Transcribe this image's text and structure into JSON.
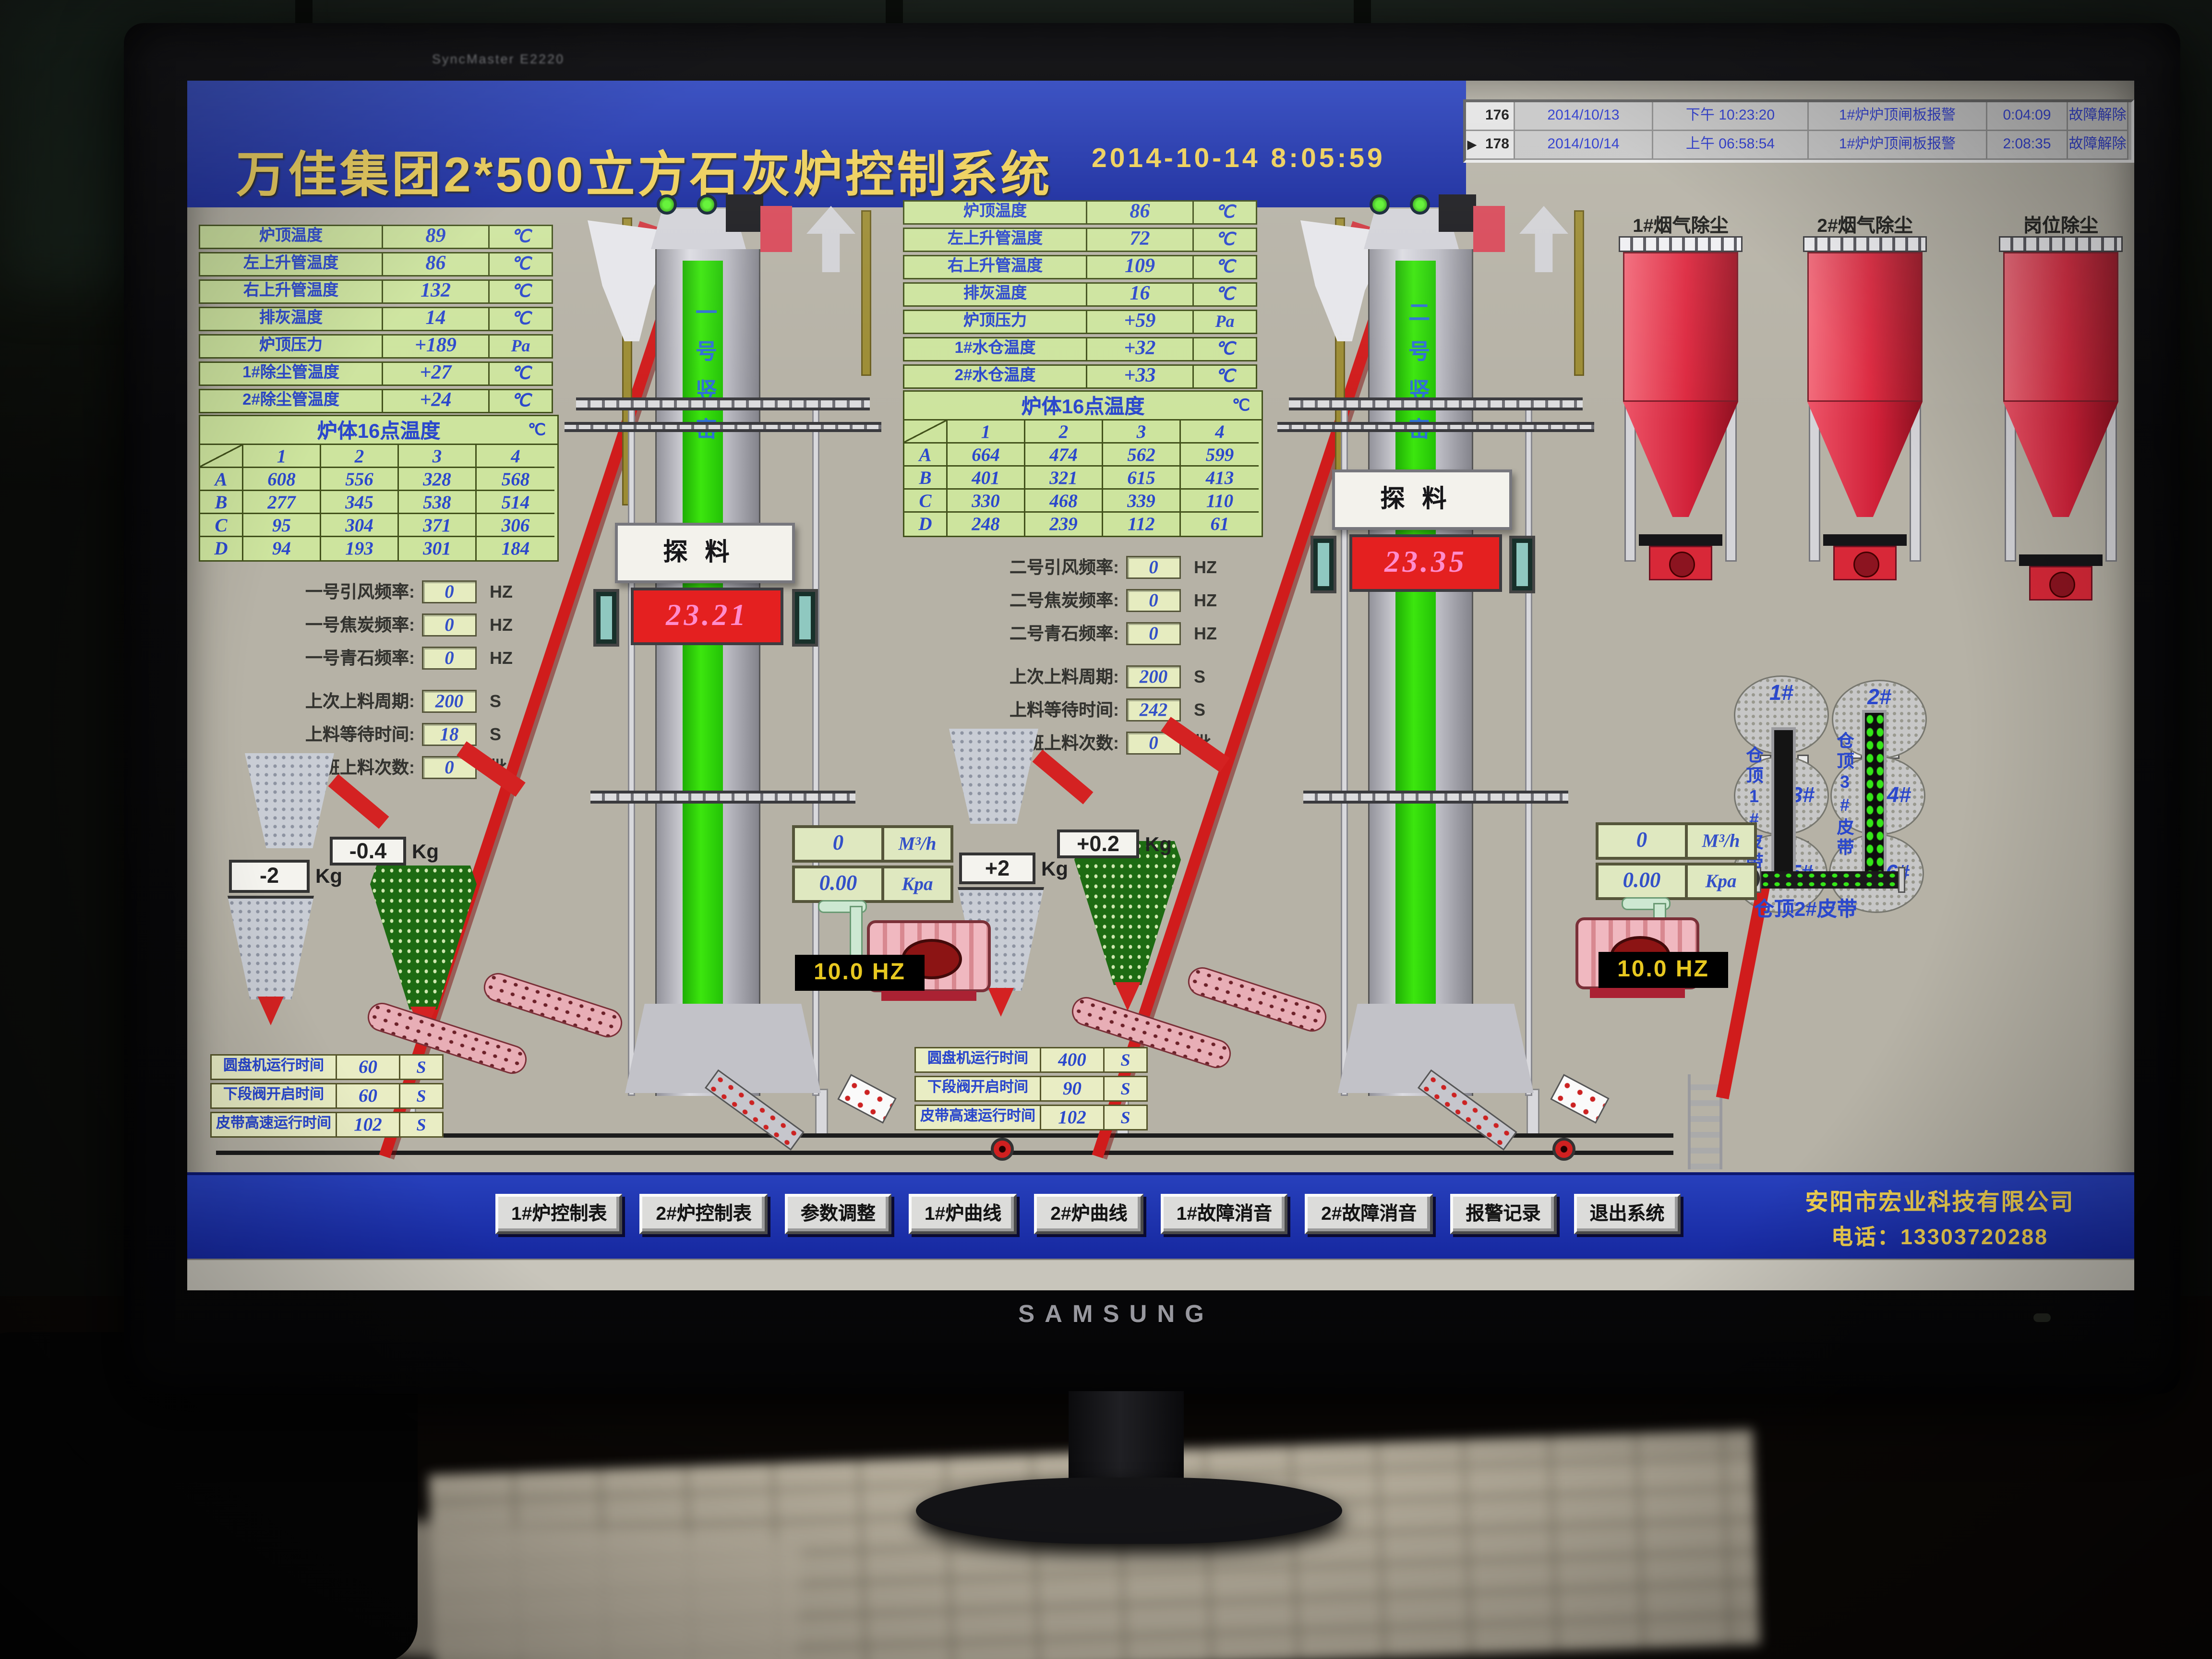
{
  "monitor": {
    "brand": "SAMSUNG",
    "model_label": "SyncMaster E2220"
  },
  "header": {
    "title": "万佳集团2*500立方石灰炉控制系统",
    "datetime": "2014-10-14 8:05:59"
  },
  "alarm_log": {
    "rows": [
      {
        "marker": "",
        "id": "176",
        "date": "2014/10/13",
        "time": "下午 10:23:20",
        "message": "1#炉炉顶闸板报警",
        "duration": "0:04:09",
        "status": "故障解除",
        "cls": "cleared"
      },
      {
        "marker": "",
        "id": "177",
        "date": "2014/10/14",
        "time": "上午 04:50:19",
        "message": "1#炉炉顶闸板报警",
        "duration": "0:00:00",
        "status": "故障报警",
        "cls": "alarm"
      },
      {
        "marker": "▶",
        "id": "178",
        "date": "2014/10/14",
        "time": "上午 06:58:54",
        "message": "1#炉炉顶闸板报警",
        "duration": "2:08:35",
        "status": "故障解除",
        "cls": "cleared"
      }
    ]
  },
  "furnace1": {
    "temps": [
      [
        "炉顶温度",
        "89",
        "℃"
      ],
      [
        "左上升管温度",
        "86",
        "℃"
      ],
      [
        "右上升管温度",
        "132",
        "℃"
      ],
      [
        "排灰温度",
        "14",
        "℃"
      ],
      [
        "炉顶压力",
        "+189",
        "Pa"
      ],
      [
        "1#除尘管温度",
        "+27",
        "℃"
      ],
      [
        "2#除尘管温度",
        "+24",
        "℃"
      ]
    ],
    "matrix_title": "炉体16点温度",
    "matrix_unit": "℃",
    "matrix_cols": [
      "1",
      "2",
      "3",
      "4"
    ],
    "matrix_rows": [
      [
        "A",
        "608",
        "556",
        "328",
        "568"
      ],
      [
        "B",
        "277",
        "345",
        "538",
        "514"
      ],
      [
        "C",
        "95",
        "304",
        "371",
        "306"
      ],
      [
        "D",
        "94",
        "193",
        "301",
        "184"
      ]
    ],
    "params": [
      [
        "一号引风频率:",
        "0",
        "HZ"
      ],
      [
        "一号焦炭频率:",
        "0",
        "HZ"
      ],
      [
        "一号青石频率:",
        "0",
        "HZ"
      ],
      [
        "上次上料周期:",
        "200",
        "S"
      ],
      [
        "上料等待时间:",
        "18",
        "S"
      ],
      [
        "本班上料次数:",
        "0",
        "批"
      ]
    ],
    "weight_coke": {
      "value": "-2",
      "unit": "Kg"
    },
    "weight_stone": {
      "value": "-0.4",
      "unit": "Kg"
    },
    "kiln_name": "一号竖窑",
    "probe_label": "探料",
    "probe_value": "23.21",
    "blower": {
      "flow": "0",
      "flow_unit": "M³/h",
      "pressure": "0.00",
      "pressure_unit": "Kpa",
      "freq": "10.0 HZ"
    },
    "runtime": [
      [
        "圆盘机运行时间",
        "60",
        "S"
      ],
      [
        "下段阀开启时间",
        "60",
        "S"
      ],
      [
        "皮带高速运行时间",
        "102",
        "S"
      ]
    ]
  },
  "furnace2": {
    "temps": [
      [
        "炉顶温度",
        "86",
        "℃"
      ],
      [
        "左上升管温度",
        "72",
        "℃"
      ],
      [
        "右上升管温度",
        "109",
        "℃"
      ],
      [
        "排灰温度",
        "16",
        "℃"
      ],
      [
        "炉顶压力",
        "+59",
        "Pa"
      ],
      [
        "1#水仓温度",
        "+32",
        "℃"
      ],
      [
        "2#水仓温度",
        "+33",
        "℃"
      ]
    ],
    "matrix_title": "炉体16点温度",
    "matrix_unit": "℃",
    "matrix_cols": [
      "1",
      "2",
      "3",
      "4"
    ],
    "matrix_rows": [
      [
        "A",
        "664",
        "474",
        "562",
        "599"
      ],
      [
        "B",
        "401",
        "321",
        "615",
        "413"
      ],
      [
        "C",
        "330",
        "468",
        "339",
        "110"
      ],
      [
        "D",
        "248",
        "239",
        "112",
        "61"
      ]
    ],
    "params": [
      [
        "二号引风频率:",
        "0",
        "HZ"
      ],
      [
        "二号焦炭频率:",
        "0",
        "HZ"
      ],
      [
        "二号青石频率:",
        "0",
        "HZ"
      ],
      [
        "上次上料周期:",
        "200",
        "S"
      ],
      [
        "上料等待时间:",
        "242",
        "S"
      ],
      [
        "本班上料次数:",
        "0",
        "批"
      ]
    ],
    "weight_coke": {
      "value": "+2",
      "unit": "Kg"
    },
    "weight_stone": {
      "value": "+0.2",
      "unit": "Kg"
    },
    "kiln_name": "二号竖窑",
    "probe_label": "探料",
    "probe_value": "23.35",
    "blower": {
      "flow": "0",
      "flow_unit": "M³/h",
      "pressure": "0.00",
      "pressure_unit": "Kpa",
      "freq": "10.0 HZ"
    },
    "runtime": [
      [
        "圆盘机运行时间",
        "400",
        "S"
      ],
      [
        "下段阀开启时间",
        "90",
        "S"
      ],
      [
        "皮带高速运行时间",
        "102",
        "S"
      ]
    ]
  },
  "dust_collectors": [
    "1#烟气除尘",
    "2#烟气除尘",
    "岗位除尘"
  ],
  "silo_cluster": {
    "bins": [
      "1#",
      "2#",
      "3#",
      "4#",
      "5#",
      "6#"
    ],
    "belt1_label": "仓顶1#皮带",
    "belt3_label": "仓顶3#皮带",
    "belt2_label": "仓顶2#皮带"
  },
  "toolbar": {
    "buttons": [
      "1#炉控制表",
      "2#炉控制表",
      "参数调整",
      "1#炉曲线",
      "2#炉曲线",
      "1#故障消音",
      "2#故障消音",
      "报警记录",
      "退出系统"
    ]
  },
  "footer": {
    "company": "安阳市宏业科技有限公司",
    "phone": "电话：13303720288"
  }
}
